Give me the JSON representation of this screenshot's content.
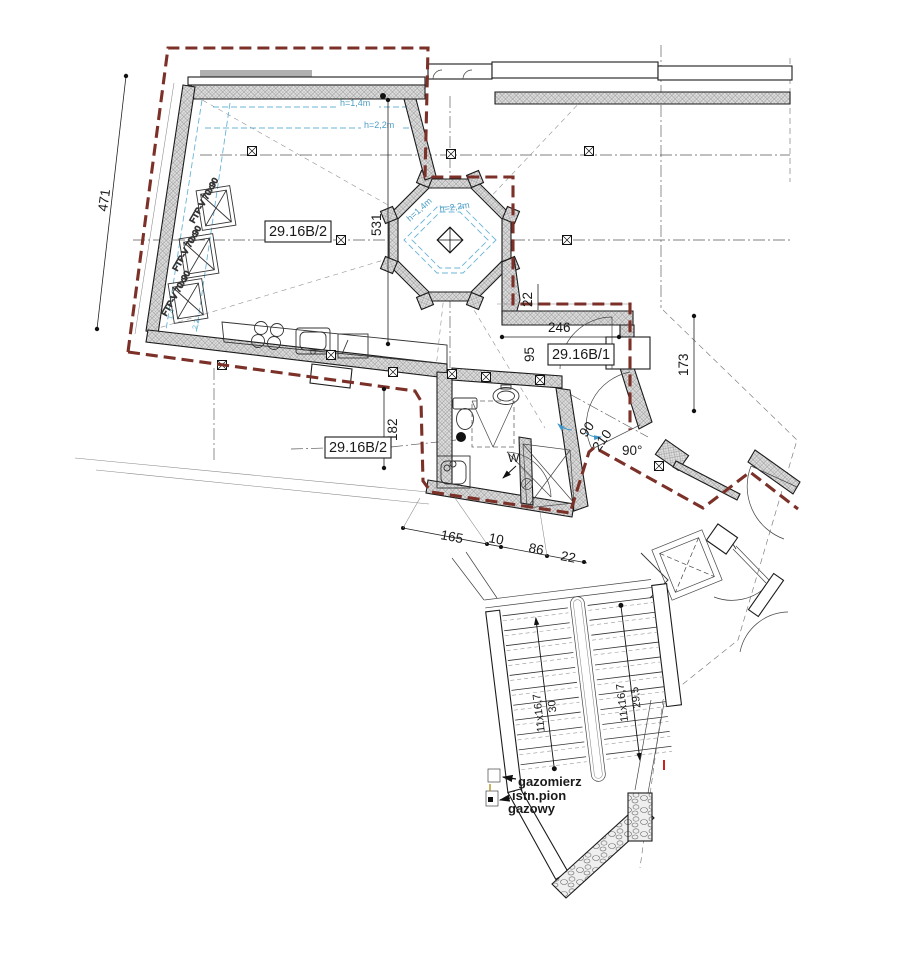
{
  "plan": {
    "title_hint": "architectural attic floor plan",
    "colors": {
      "boundary": "#7b3028",
      "height_lines": "#6ab4d8",
      "wall_hatch_bg": "#e0e0e0",
      "ink": "#1a1a1a"
    },
    "rooms": {
      "b2": "29.16B/2",
      "b1": "29.16B/1"
    },
    "heights": {
      "h14": "h=1,4m",
      "h22": "h=2,2m",
      "sky14": "1,4",
      "sky22": "2,2"
    },
    "skylight": {
      "label": "FTP-V 70x90"
    },
    "dimensions": {
      "d471": "471",
      "d531": "531",
      "d22_wall": "22",
      "d246": "246",
      "d95": "95",
      "d173": "173",
      "d182": "182",
      "d90": "90",
      "d210": "210",
      "angle90": "90°",
      "d165": "165",
      "d10": "10",
      "d86": "86",
      "d22_chain": "22"
    },
    "stairs": {
      "run": "11x16,7",
      "width_left": "30",
      "width_right": "29,5"
    },
    "gas": {
      "meter": "gazomierz",
      "riser1": "istn.pion",
      "riser2": "gazowy"
    },
    "fixtures": {
      "washer_mark": "W"
    }
  }
}
